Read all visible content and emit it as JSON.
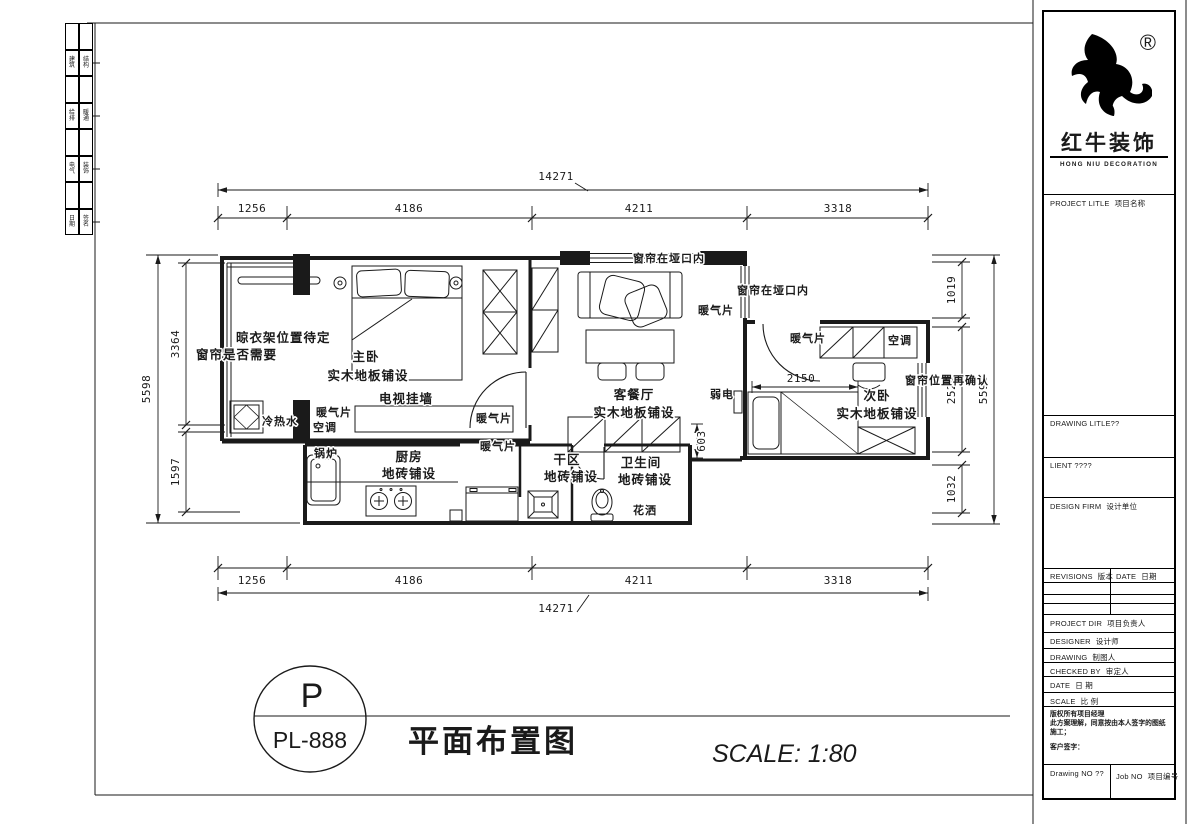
{
  "colors": {
    "ink": "#1a1a1a",
    "paper": "#ffffff"
  },
  "edge_strip": {
    "rows": [
      {
        "l": "建筑",
        "r": "结构"
      },
      {
        "l": "给排",
        "r": "暖通"
      },
      {
        "l": "电气",
        "r": "装饰"
      },
      {
        "l": "日期",
        "r": "签名"
      }
    ]
  },
  "brand": {
    "reg": "®",
    "cn": "红牛装饰",
    "en": "HONG NIU DECORATION"
  },
  "tb": {
    "project_title_en": "PROJECT LITLE",
    "project_title_cn": "项目名称",
    "drawing_title": "DRAWING LITLE??",
    "client": "LIENT ????",
    "design_firm_en": "DESIGN FIRM",
    "design_firm_cn": "设计单位",
    "revisions_en": "REVISIONS",
    "revisions_cn": "版本",
    "rev_date_en": "DATE",
    "rev_date_cn": "日期",
    "project_dir_en": "PROJECT DIR",
    "project_dir_cn": "项目负责人",
    "designer_en": "DESIGNER",
    "designer_cn": "设计师",
    "drawing_en": "DRAWING",
    "drawing_cn": "制图人",
    "checked_en": "CHECKED BY",
    "checked_cn": "审定人",
    "date_en": "DATE",
    "date_cn": "日 期",
    "scale_en": "SCALE",
    "scale_cn": "比 例",
    "note1": "版权所有项目经理",
    "note2": "此方案理解，同意按由本人签字的图纸施工；",
    "note3": "客户签字：",
    "drawing_no": "Drawing NO ??",
    "job_no_en": "Job NO",
    "job_no_cn": "项目编号"
  },
  "title_bar": {
    "letter": "P",
    "code": "PL-888",
    "title": "平面布置图",
    "scale": "SCALE:  1:80"
  },
  "dims": {
    "h_overall": "14271",
    "h1": "1256",
    "h2": "4186",
    "h3": "4211",
    "h4": "3318",
    "v_overall": "5598",
    "l1": "3364",
    "l2": "1597",
    "r1": "1019",
    "r2": "2524",
    "r3": "1032",
    "bed2_width": "2150",
    "bath_depth": "603"
  },
  "labels": {
    "hanger_tbd": "晾衣架位置待定",
    "curtain_needed": "窗帘是否需要",
    "master_bedroom": "主卧",
    "wood_floor": "实木地板铺设",
    "tv_wall": "电视挂墙",
    "radiator": "暖气片",
    "ac": "空调",
    "hot_cold_water": "冷热水",
    "boiler": "锅炉",
    "kitchen": "厨房",
    "tile_floor": "地砖铺设",
    "dry_area": "干区",
    "bathroom": "卫生间",
    "shower": "花洒",
    "curtain_in_opening": "窗帘在垭口内",
    "living_dining": "客餐厅",
    "weak_current": "弱电",
    "second_bedroom": "次卧",
    "curtain_reconfirm": "窗帘位置再确认"
  }
}
